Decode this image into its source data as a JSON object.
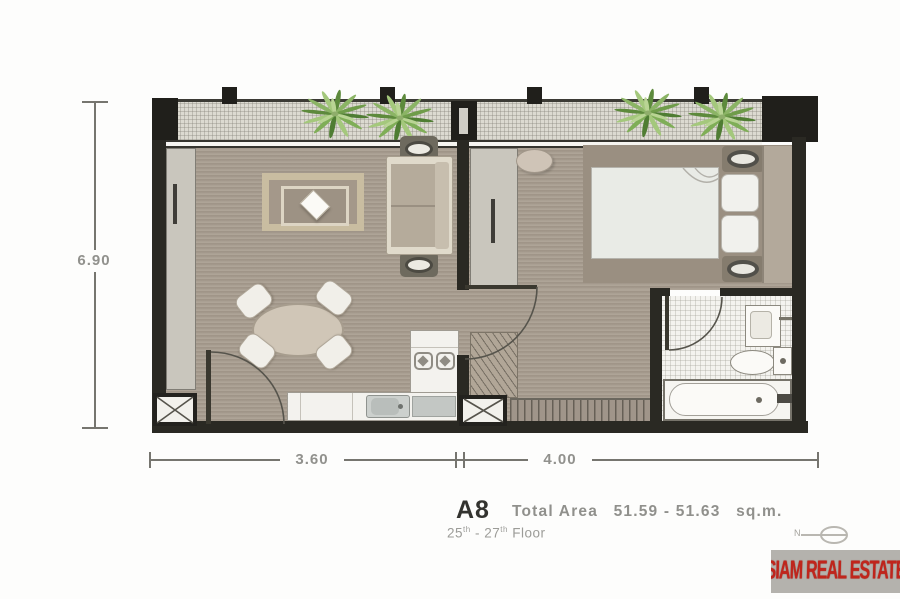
{
  "dimensions": {
    "left_height_m": "6.90",
    "bottom_left_m": "3.60",
    "bottom_right_m": "4.00"
  },
  "caption": {
    "unit": "A8",
    "area_label": "Total Area",
    "area_value": "51.59 - 51.63",
    "area_unit": "sq.m.",
    "floor_from": "25",
    "ordinal_suffix": "th",
    "floor_separator": "-",
    "floor_to": "27",
    "floor_word": "Floor"
  },
  "compass": {
    "label": "N"
  },
  "watermark": {
    "text": "SIAM REAL ESTATE"
  },
  "colors": {
    "wall": "#2a2923",
    "floor": "#a89d8f",
    "balcony": "#dcdad1",
    "plant_green": "#6f9c4a",
    "watermark_red": "#c0251c"
  }
}
